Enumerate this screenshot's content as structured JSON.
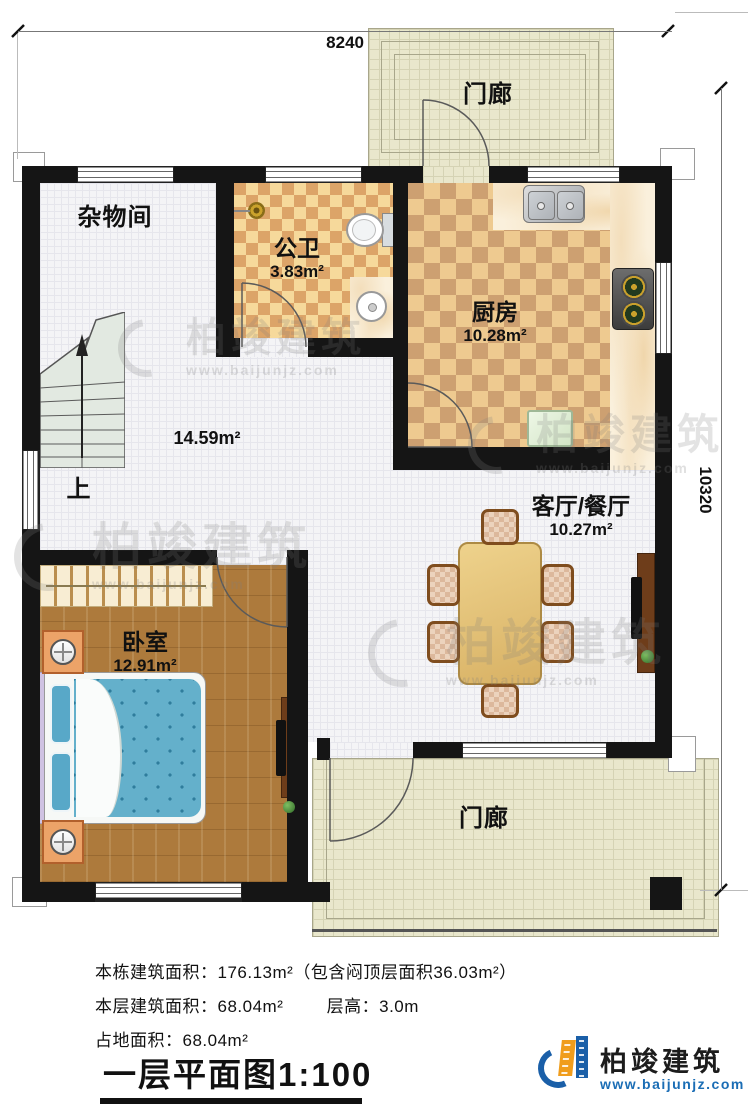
{
  "plan": {
    "dim_top": "8240",
    "dim_right": "10320",
    "rooms": {
      "porch_top": {
        "name": "门廊"
      },
      "porch_bottom": {
        "name": "门廊"
      },
      "storage": {
        "name": "杂物间"
      },
      "bathroom": {
        "name": "公卫",
        "area": "3.83m²"
      },
      "kitchen": {
        "name": "厨房",
        "area": "10.28m²"
      },
      "hall": {
        "area": "14.59m²",
        "stairs_up": "上"
      },
      "living_dining": {
        "name": "客厅/餐厅",
        "area": "10.27m²"
      },
      "bedroom": {
        "name": "卧室",
        "area": "12.91m²"
      }
    }
  },
  "footer": {
    "line1": "本栋建筑面积：176.13m²（包含闷顶层面积36.03m²）",
    "line2a": "本层建筑面积：68.04m²",
    "line2b": "层高：3.0m",
    "line3": "占地面积：68.04m²",
    "title": "一层平面图1:100"
  },
  "watermark": {
    "text": "柏竣建筑",
    "url": "www.baijunjz.com"
  },
  "logo": {
    "text": "柏竣建筑",
    "url": "www.baijunjz.com"
  },
  "colors": {
    "wall": "#151515",
    "accent_blue": "#1a5fa8",
    "accent_orange": "#f09d1c"
  }
}
